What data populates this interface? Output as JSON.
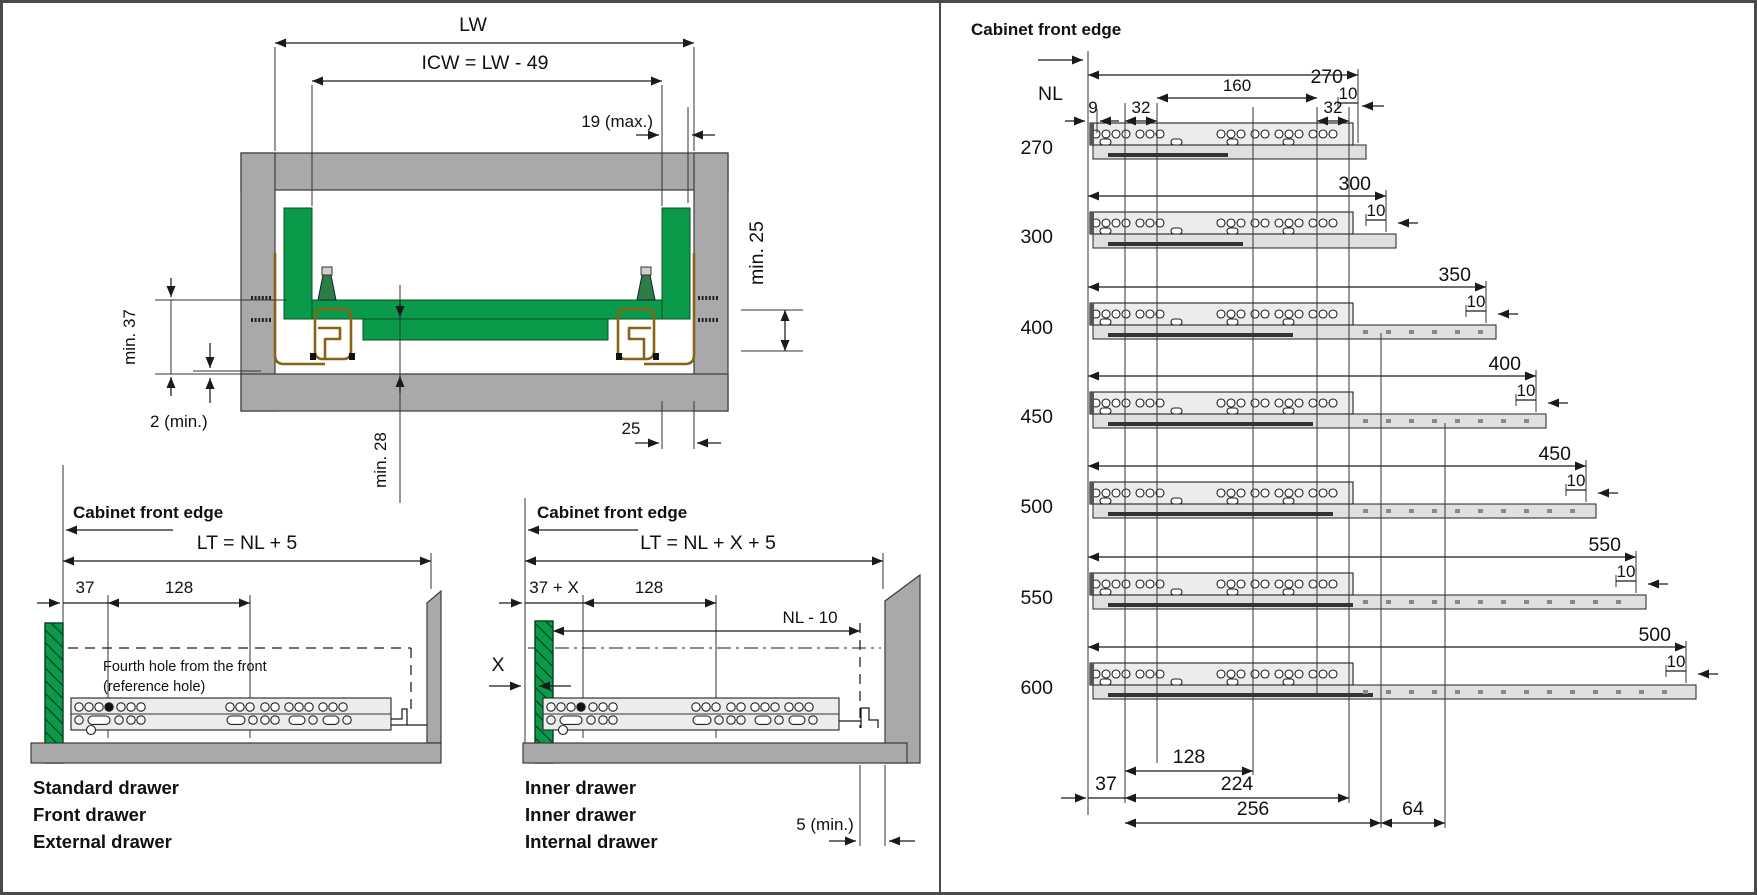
{
  "left_panel": {
    "cross_section": {
      "lw_label": "LW",
      "icw_label": "ICW = LW - 49",
      "max19_label": "19 (max.)",
      "min25_label": "min. 25",
      "min37_label": "min. 37",
      "min2_label": "2 (min.)",
      "min28_label": "min. 28",
      "d25_label": "25"
    },
    "standard_drawer": {
      "front_edge_label": "Cabinet front edge",
      "lt_label": "LT = NL + 5",
      "d37_label": "37",
      "d128_label": "128",
      "note_line1": "Fourth hole from the front",
      "note_line2": "(reference hole)",
      "captions": [
        "Standard drawer",
        "Front drawer",
        "External drawer"
      ]
    },
    "inner_drawer": {
      "front_edge_label": "Cabinet front edge",
      "lt_label": "LT = NL + X + 5",
      "d37x_label": "37 + X",
      "d128_label": "128",
      "nl10_label": "NL - 10",
      "x_label": "X",
      "min5_label": "5 (min.)",
      "captions": [
        "Inner drawer",
        "Inner drawer",
        "Internal drawer"
      ]
    }
  },
  "right_panel": {
    "front_edge_label": "Cabinet front edge",
    "nl_header": "NL",
    "top_dims": {
      "d160": "160",
      "d9": "9",
      "d32a": "32",
      "d32b": "32"
    },
    "rows": [
      {
        "nl": "270",
        "end_dim": "270",
        "offset_dim": "10"
      },
      {
        "nl": "300",
        "end_dim": "300",
        "offset_dim": "10"
      },
      {
        "nl": "400",
        "end_dim": "350",
        "offset_dim": "10"
      },
      {
        "nl": "450",
        "end_dim": "400",
        "offset_dim": "10"
      },
      {
        "nl": "500",
        "end_dim": "450",
        "offset_dim": "10"
      },
      {
        "nl": "550",
        "end_dim": "550",
        "offset_dim": "10"
      },
      {
        "nl": "600",
        "end_dim": "500",
        "offset_dim": "10"
      }
    ],
    "bottom_dims": {
      "d37": "37",
      "d128": "128",
      "d224": "224",
      "d256": "256",
      "d64": "64"
    }
  },
  "colors": {
    "drawer_green": "#0a9a4a",
    "runner_brown": "#8a6215",
    "cabinet_gray": "#a9a9a9",
    "line": "#1a1a1a"
  }
}
